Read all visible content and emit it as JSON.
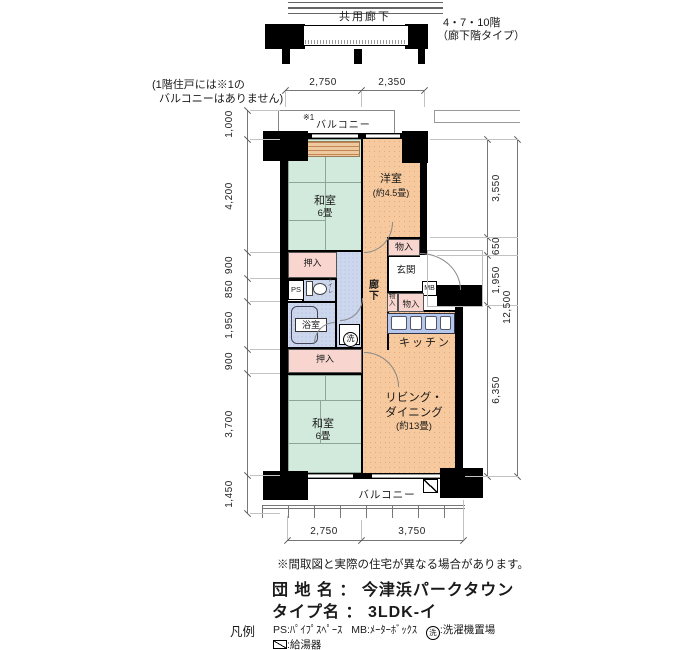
{
  "header": {
    "corridor": "共用廊下",
    "floors": "4・7・10階",
    "floor_type": "（廊下階タイプ）"
  },
  "note": {
    "line1": "(1階住戸には※1の",
    "line2": "バルコニーはありません)"
  },
  "plan": {
    "balcony_top_ref": "※1",
    "balcony_top": "バルコニー",
    "washitsu1": "和室",
    "washitsu1_size": "6畳",
    "yoshitsu": "洋室",
    "yoshitsu_size": "(約4.5畳)",
    "monoire_top": "物入",
    "oshiire1": "押入",
    "ps": "PS",
    "toilet": "トイレ",
    "bath": "浴室",
    "wash": "洗",
    "hall": "廊下",
    "genkan": "玄関",
    "mb": "MB",
    "monoire_v": "物入",
    "monoire_h": "物入",
    "kitchen": "キッチン",
    "oshiire2": "押入",
    "washitsu2": "和室",
    "washitsu2_size": "6畳",
    "living1": "リビング・",
    "living2": "ダイニング",
    "living3": "(約13畳)",
    "balcony_bottom": "バルコニー"
  },
  "dims": {
    "top": [
      "2,750",
      "2,350"
    ],
    "left": [
      "1,000",
      "4,200",
      "900",
      "850",
      "1,950",
      "900",
      "3,700",
      "1,450"
    ],
    "right": [
      "3,550",
      "650",
      "1,950",
      "6,350"
    ],
    "right_total": "12,500",
    "bottom": [
      "2,750",
      "3,750"
    ]
  },
  "footer": {
    "disclaimer": "※間取図と実際の住宅が異なる場合があります。",
    "estate_label": "団 地 名",
    "colon": "：",
    "estate_name": "今津浜パークタウン",
    "type_label": "タイプ名",
    "type_value": "3LDK-イ",
    "legend_title": "凡例",
    "legend_ps": "PS:ﾊﾟｲﾌﾟｽﾍﾟｰｽ",
    "legend_mb": "MB:ﾒｰﾀｰﾎﾞｯｸｽ",
    "legend_wash_symbol": "洗",
    "legend_wash": ":洗濯機置場",
    "legend_heater": ":給湯器"
  },
  "colors": {
    "tatami_green": "#d2eadb",
    "room_orange": "#f6c99e",
    "water_blue": "#ccd7ee",
    "closet_pink": "#f8d6cf",
    "counter_blue": "#b3c8ec",
    "wall_black": "#000000"
  }
}
